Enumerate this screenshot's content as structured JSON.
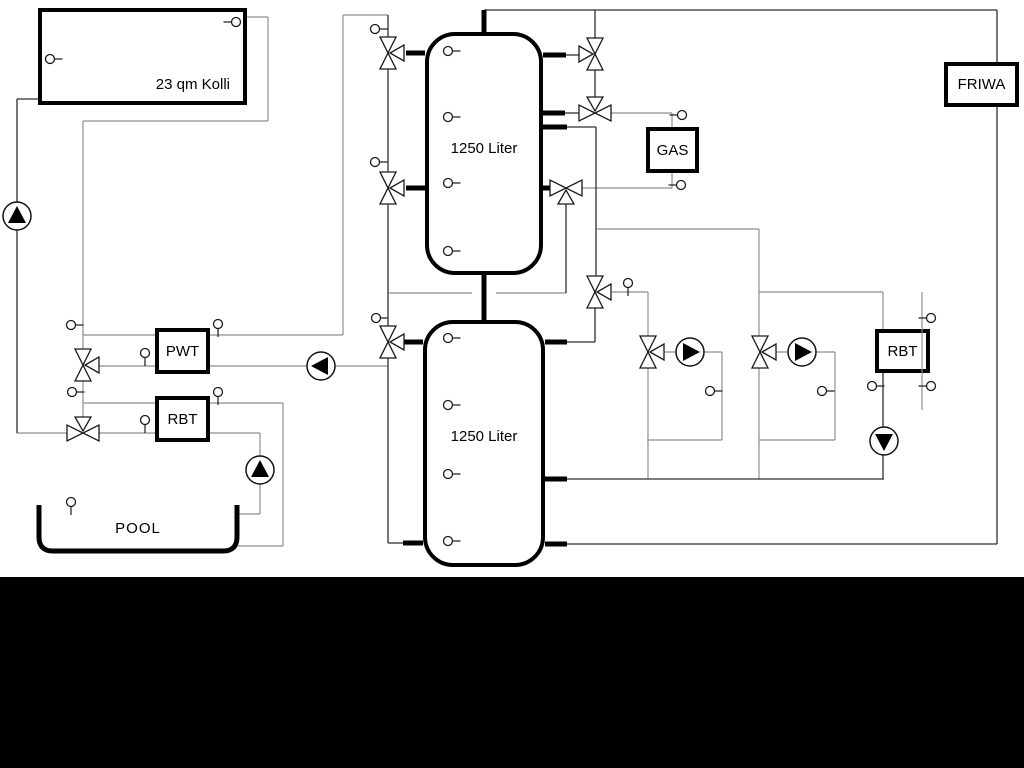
{
  "window": {
    "background": "#ffffff",
    "footer_band_color": "#000000"
  },
  "diagram": {
    "type": "hydraulic-heating-schematic",
    "labels": {
      "collector": "23 qm Kolli",
      "tank1": "1250 Liter",
      "tank2": "1250 Liter",
      "gas": "GAS",
      "friwa": "FRIWA",
      "pwt": "PWT",
      "rbt_left": "RBT",
      "rbt_right": "RBT",
      "pool": "POOL"
    },
    "icons": {
      "valve": "three-way-valve-icon",
      "pump": "pump-icon",
      "sensor": "temperature-sensor-icon"
    },
    "colors": {
      "line_gray": "#8e8e8e",
      "line_dark": "#2f2f2f",
      "component_black": "#000000",
      "box_fill": "#ffffff"
    }
  }
}
